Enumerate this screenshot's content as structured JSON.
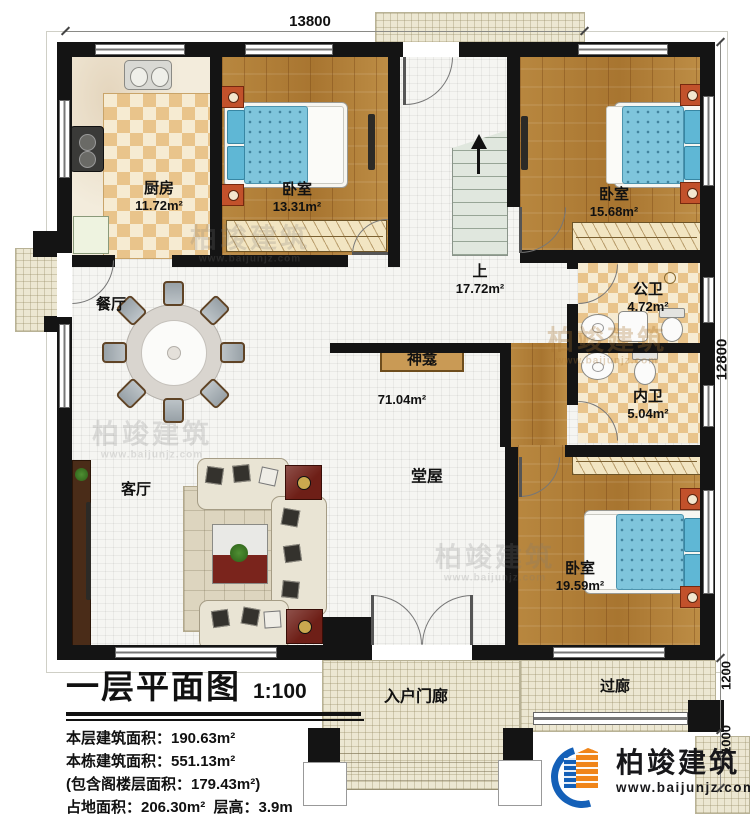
{
  "plan": {
    "rooms": {
      "kitchen": {
        "name": "厨房",
        "area": "11.72m²"
      },
      "bedroom1": {
        "name": "卧室",
        "area": "13.31m²"
      },
      "bedroom2": {
        "name": "卧室",
        "area": "15.68m²"
      },
      "stair_hall": {
        "name": "上",
        "area": "17.72m²"
      },
      "public_bath": {
        "name": "公卫",
        "area": "4.72m²"
      },
      "inner_bath": {
        "name": "内卫",
        "area": "5.04m²"
      },
      "bedroom3": {
        "name": "卧室",
        "area": "19.59m²"
      },
      "dining": {
        "name": "餐厅"
      },
      "living": {
        "name": "客厅"
      },
      "main_hall": {
        "name": "堂屋",
        "area": "71.04m²"
      },
      "shrine": {
        "name": "神龛"
      },
      "entry_porch": {
        "name": "入户门廊"
      },
      "corridor": {
        "name": "过廊"
      }
    },
    "dimensions": {
      "top": "13800",
      "right": "12800",
      "right_corridor": "1200",
      "right_porch": "1000"
    }
  },
  "title_block": {
    "title": "一层平面图",
    "scale": "1:100",
    "stats": [
      "本层建筑面积：190.63m²",
      "本栋建筑面积：551.13m²",
      "(包含阁楼层面积：179.43m²)",
      "占地面积：206.30m²  层高：3.9m"
    ]
  },
  "brand": {
    "name": "柏竣建筑",
    "url": "www.baijunjz.com"
  },
  "watermark": {
    "text": "柏竣建筑",
    "url": "www.baijunjz.com"
  },
  "colors": {
    "wall": "#141414",
    "wood": "#b0813c",
    "bed_blue": "#7fc5dc",
    "checker_tan": "#e9c48b",
    "accent_blue": "#1460b8",
    "accent_orange": "#f08519"
  }
}
